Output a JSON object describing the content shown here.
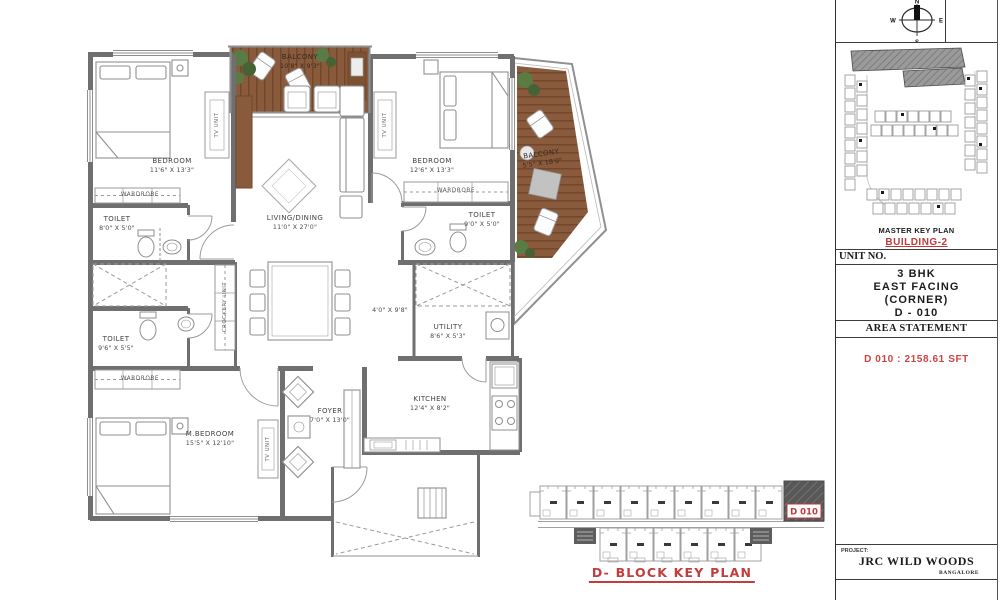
{
  "document": {
    "type": "apartment floor plan sheet"
  },
  "plan": {
    "rooms": {
      "bedroom1": {
        "name": "BEDROOM",
        "dims": "11'6\" X 13'3\""
      },
      "toilet1": {
        "name": "TOILET",
        "dims": "8'0\" X 5'0\""
      },
      "balcony_top": {
        "name": "BALCONY",
        "dims": "10'8\" X 9'3\""
      },
      "living": {
        "name": "LIVING/DINING",
        "dims": "11'0\" X 27'0\""
      },
      "bedroom2": {
        "name": "BEDROOM",
        "dims": "12'6\" X 13'3\""
      },
      "toilet2": {
        "name": "TOILET",
        "dims": "9'0\" X 5'0\""
      },
      "balcony_right": {
        "name": "BALCONY",
        "dims": "5'5\" X 18'0\""
      },
      "toilet3": {
        "name": "TOILET",
        "dims": "9'6\" X 5'5\""
      },
      "mbedroom": {
        "name": "M.BEDROOM",
        "dims": "15'5\" X 12'10\""
      },
      "foyer": {
        "name": "FOYER",
        "dims": "7'0\" X 13'0\""
      },
      "utility": {
        "name": "UTILITY",
        "dims": "8'6\" X 5'3\""
      },
      "kitchen": {
        "name": "KITCHEN",
        "dims": "12'4\" X 8'2\""
      },
      "passage": {
        "dims": "4'0\" X 9'8\""
      }
    },
    "fixtures": {
      "wardrobe": "WARDROBE",
      "tv_unit": "TV UNIT",
      "crockery_unit": "CROCKERY UNIT"
    }
  },
  "key_plan": {
    "title": "D- BLOCK KEY PLAN",
    "highlight_label": "D 010"
  },
  "panel": {
    "compass": {
      "n": "N",
      "s": "S",
      "e": "E",
      "w": "W"
    },
    "master_key_plan_label": "MASTER KEY PLAN",
    "building_label": "BUILDING-2",
    "unit_no_label": "UNIT NO.",
    "unit_info": {
      "line1": "3 BHK",
      "line2": "EAST FACING",
      "line3": "(CORNER)",
      "line4": "D - 010"
    },
    "area_statement_label": "AREA STATEMENT",
    "area_value": "D 010 : 2158.61 SFT",
    "project_label": "PROJECT:",
    "project_name": "JRC WILD WOODS",
    "project_city": "BANGALORE"
  },
  "colors": {
    "accent_red": "#c43c3c",
    "wall_gray": "#6f6f70",
    "deck_brown": "#8a5a3c",
    "plant_green": "#5a7c44"
  }
}
